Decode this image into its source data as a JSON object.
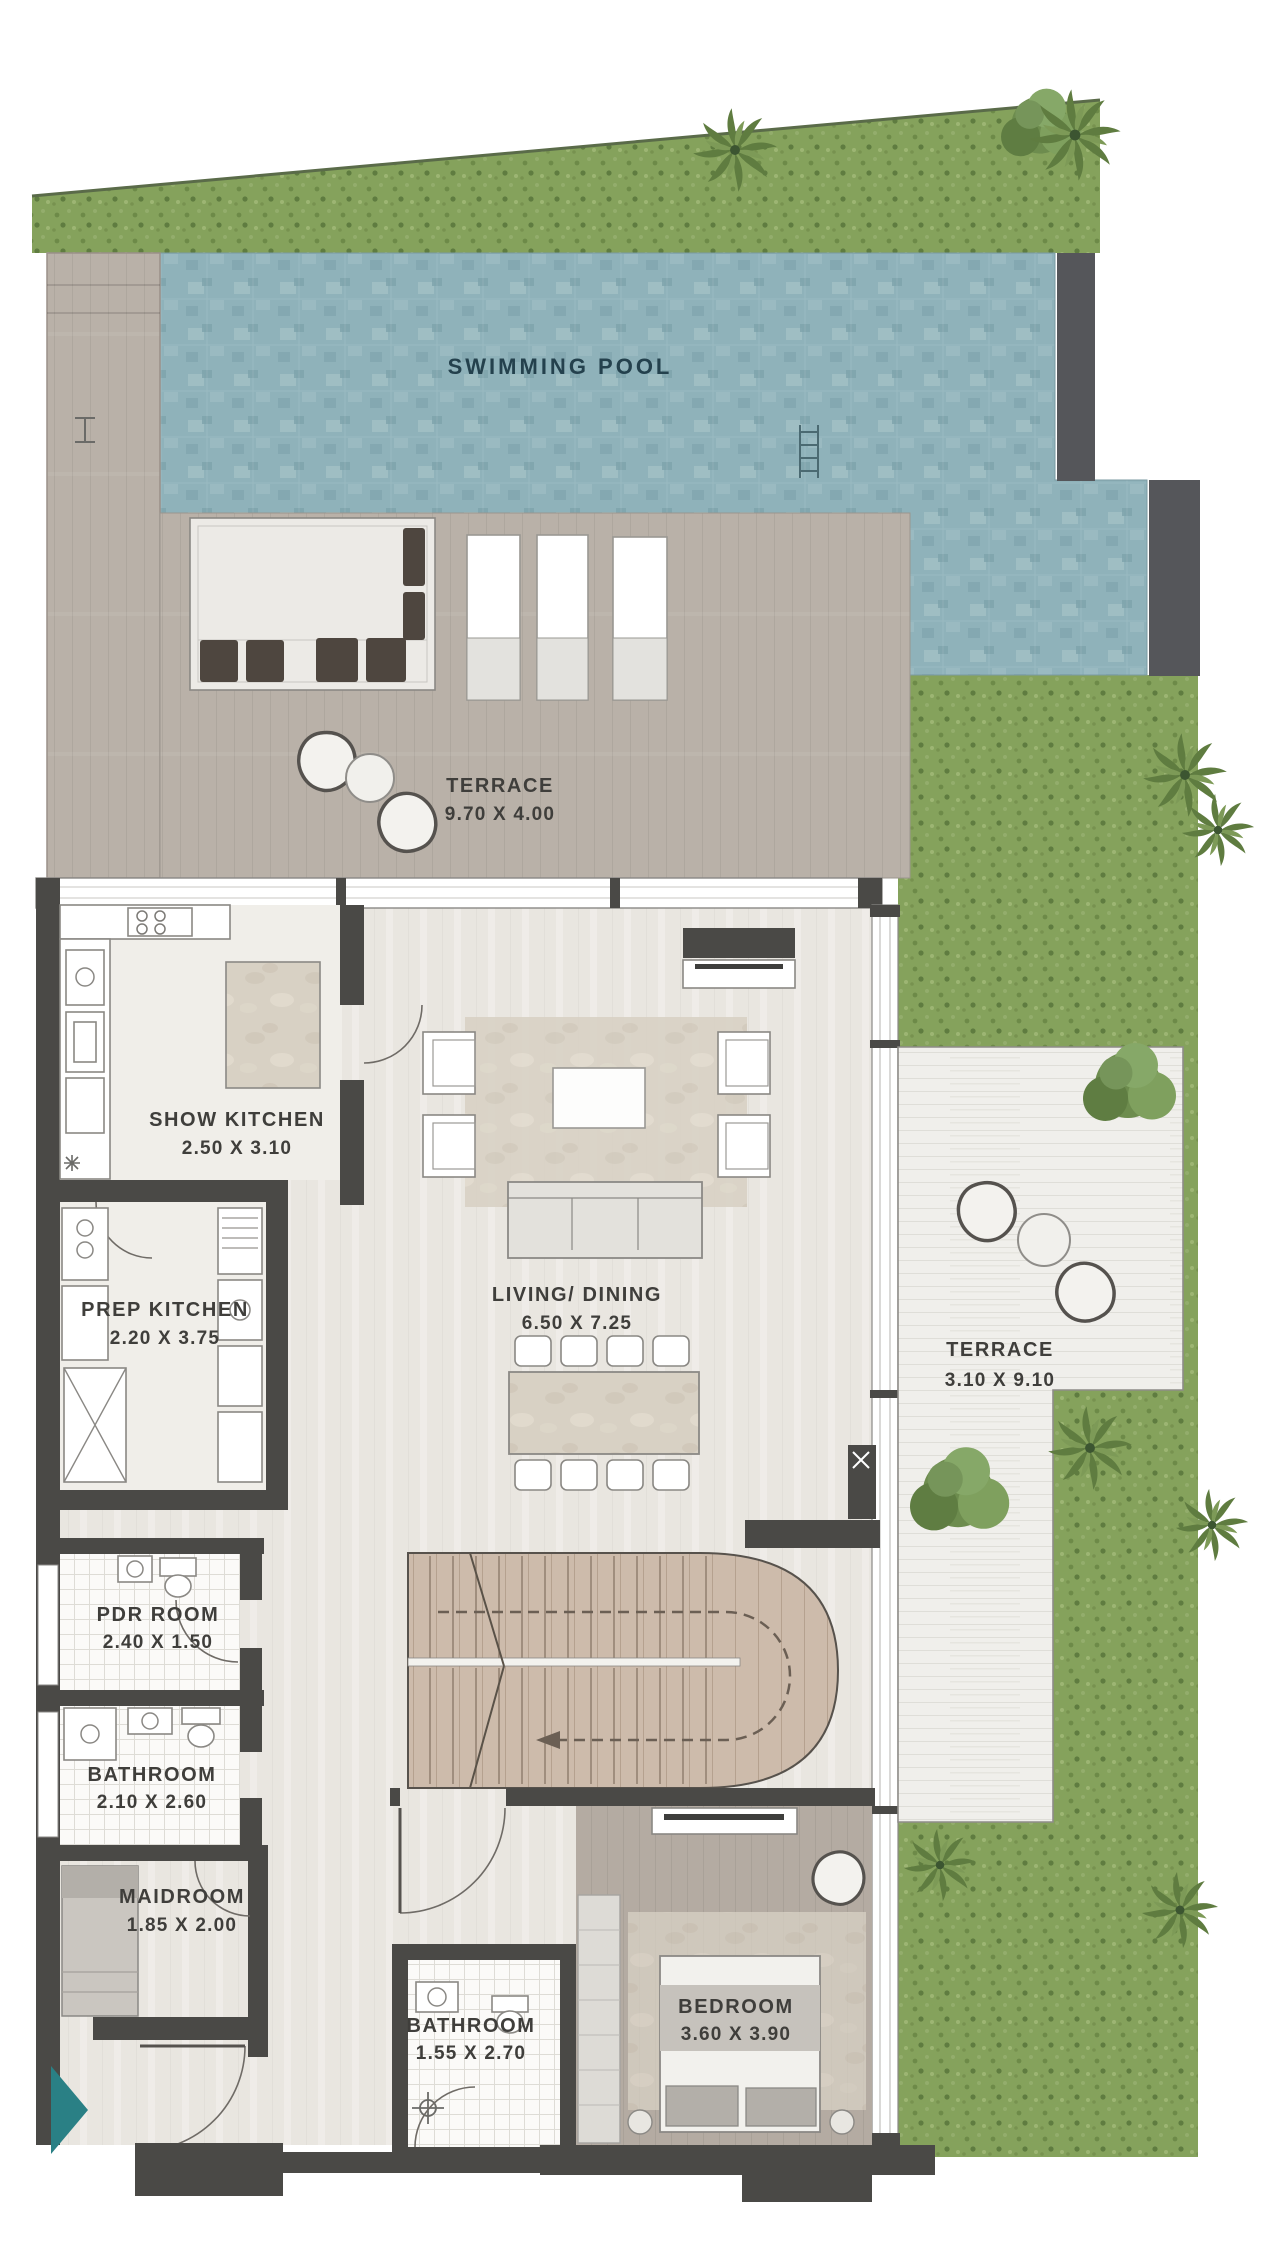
{
  "title": "Floor Plan",
  "colors": {
    "wall": "#4a4946",
    "pool": "#8fb2ba",
    "pool_light": "#a2c0c6",
    "pool_dark": "#7da2ab",
    "pool_wall": "#55565a",
    "grass": "#85a25c",
    "grass_dark": "#5f7c40",
    "deck": "#b9b1a8",
    "plank": "#f0efeb",
    "floor": "#e9e6e0",
    "tile": "#fbfaf8",
    "stair_wood": "#cdbbab",
    "bed_wood": "#b4aba2",
    "marble": "#d8d1c4",
    "accent": "#2a8085",
    "label": "#3f3e3b",
    "pool_label": "#24414d",
    "furniture_dark": "#4e463f"
  },
  "rooms": {
    "swimming_pool": {
      "name": "SWIMMING POOL"
    },
    "terrace_pool": {
      "name": "TERRACE",
      "dims": "9.70 X 4.00"
    },
    "show_kitchen": {
      "name": "SHOW KITCHEN",
      "dims": "2.50 X 3.10"
    },
    "prep_kitchen": {
      "name": "PREP KITCHEN",
      "dims": "2.20 X 3.75"
    },
    "living_dining": {
      "name": "LIVING/ DINING",
      "dims": "6.50 X 7.25"
    },
    "terrace_side": {
      "name": "TERRACE",
      "dims": "3.10 X 9.10"
    },
    "pdr_room": {
      "name": "PDR ROOM",
      "dims": "2.40 X 1.50"
    },
    "bathroom_left": {
      "name": "BATHROOM",
      "dims": "2.10 X 2.60"
    },
    "maidroom": {
      "name": "MAIDROOM",
      "dims": "1.85 X 2.00"
    },
    "bathroom_lower": {
      "name": "BATHROOM",
      "dims": "1.55 X 2.70"
    },
    "bedroom": {
      "name": "BEDROOM",
      "dims": "3.60 X 3.90"
    }
  }
}
